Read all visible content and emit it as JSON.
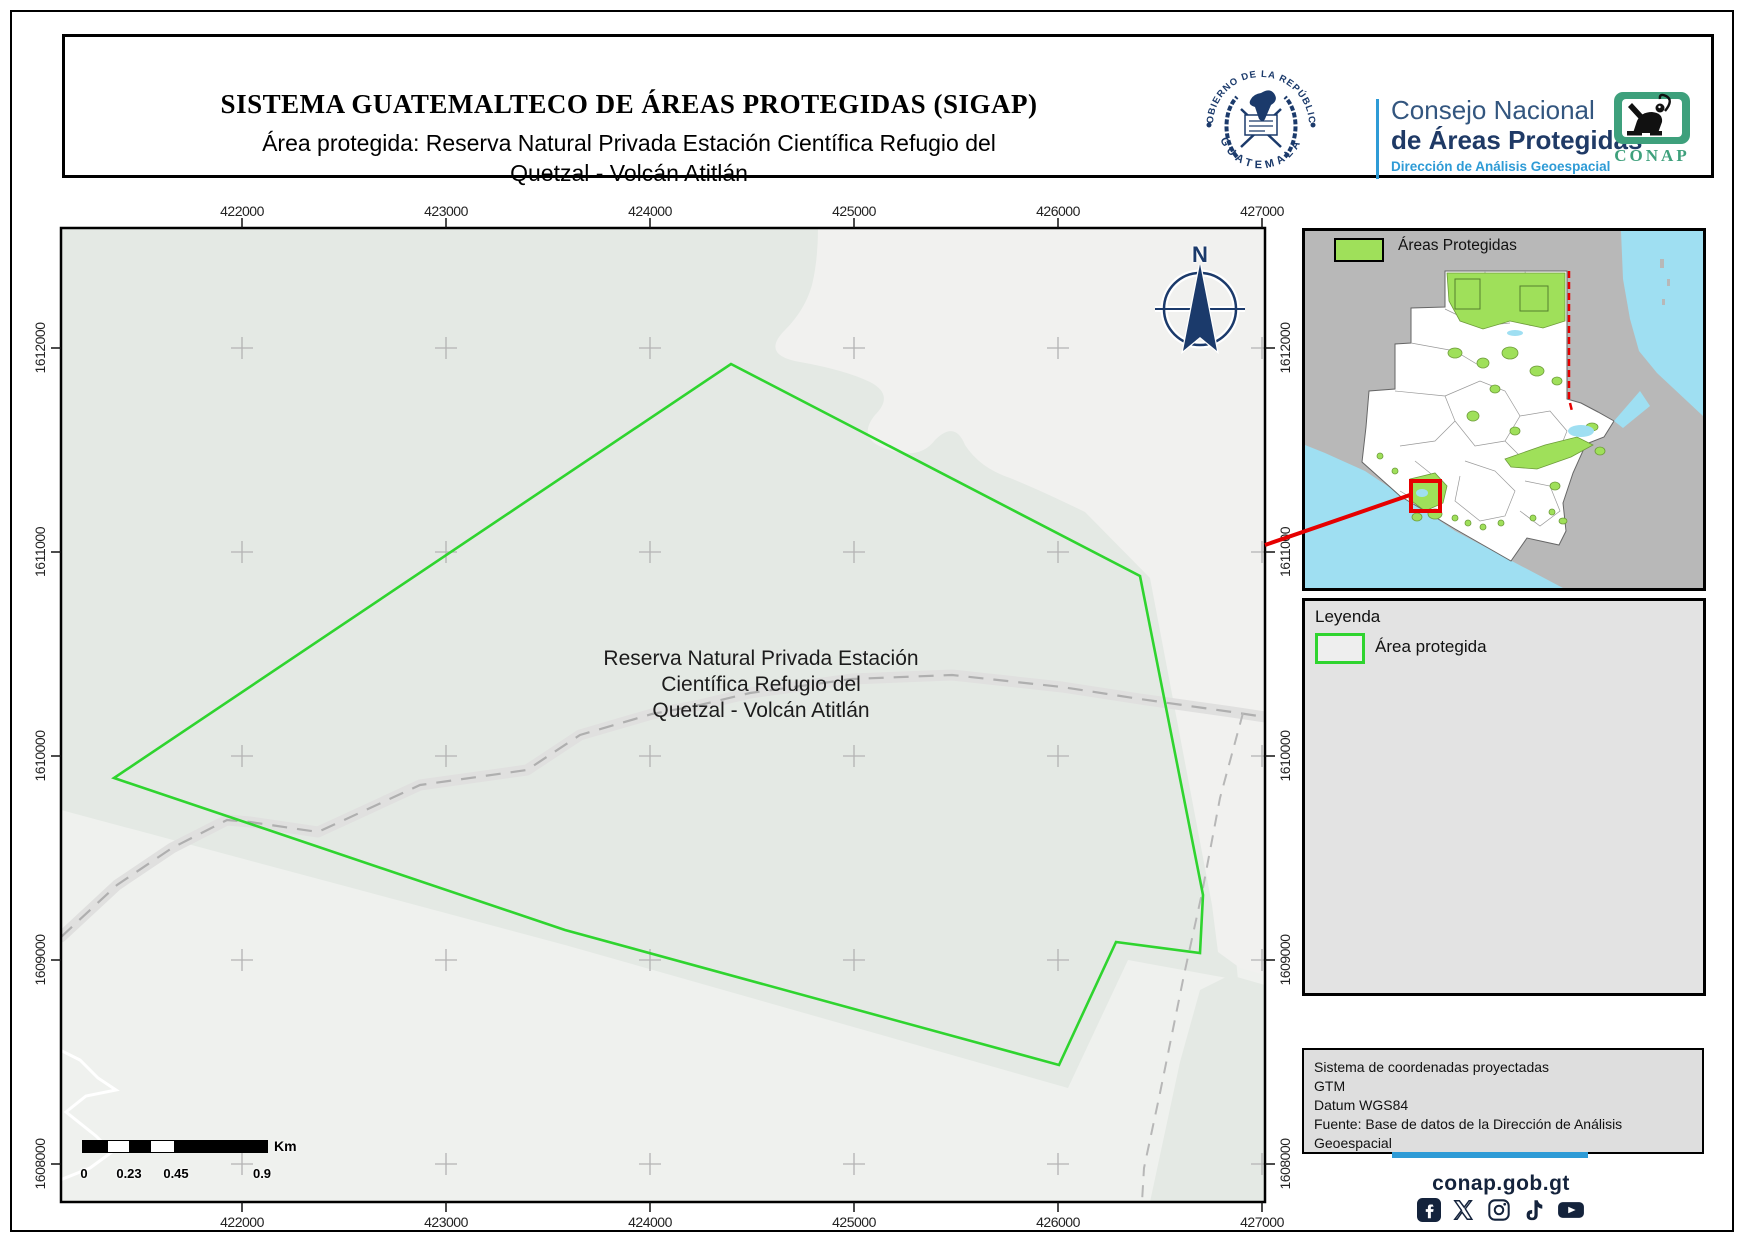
{
  "colors": {
    "green": "#2fd42f",
    "inset-green": "#9fe05a",
    "navy": "#1b3a6b",
    "blue": "#2e9bd6",
    "red": "#e60000",
    "cyan": "#9fdff2",
    "dark": "#14233c",
    "conap-green": "#3ea07c"
  },
  "header": {
    "title": "SISTEMA GUATEMALTECO DE ÁREAS PROTEGIDAS (SIGAP)",
    "subtitle": "Área protegida: Reserva Natural Privada Estación Científica Refugio del\nQuetzal - Volcán Atitlán"
  },
  "logos": {
    "seal_top": "GOBIERNO DE LA REPÚBLICA",
    "seal_bottom": "GUATEMALA",
    "council_line1": "Consejo Nacional",
    "council_line2": "de Áreas Protegidas",
    "council_line3": "Dirección de Análisis Geoespacial",
    "conap": "CONAP"
  },
  "map": {
    "axis_top": [
      "422000",
      "423000",
      "424000",
      "425000",
      "426000",
      "427000"
    ],
    "axis_bottom": [
      "422000",
      "423000",
      "424000",
      "425000",
      "426000",
      "427000"
    ],
    "axis_left": [
      "1612000",
      "1611000",
      "1610000",
      "1609000",
      "1608000"
    ],
    "axis_right": [
      "1612000",
      "1611000",
      "1610000",
      "1609000",
      "1608000"
    ],
    "area_label": "Reserva Natural Privada Estación\nCientífica Refugio del\nQuetzal - Volcán Atitlán",
    "compass_n": "N",
    "scalebar": {
      "labels": [
        "0",
        "0.23",
        "0.45",
        "0.9"
      ],
      "unit": "Km"
    }
  },
  "inset": {
    "legend_label": "Áreas Protegidas"
  },
  "legend": {
    "title": "Leyenda",
    "item_label": "Área protegida"
  },
  "projection": {
    "lines": [
      "Sistema de coordenadas proyectadas",
      "GTM",
      "Datum WGS84",
      "Fuente: Base de datos de la Dirección de Análisis Geoespacial"
    ]
  },
  "footer": {
    "site": "conap.gob.gt",
    "icons": [
      "facebook-icon",
      "x-icon",
      "instagram-icon",
      "tiktok-icon",
      "youtube-icon"
    ]
  }
}
